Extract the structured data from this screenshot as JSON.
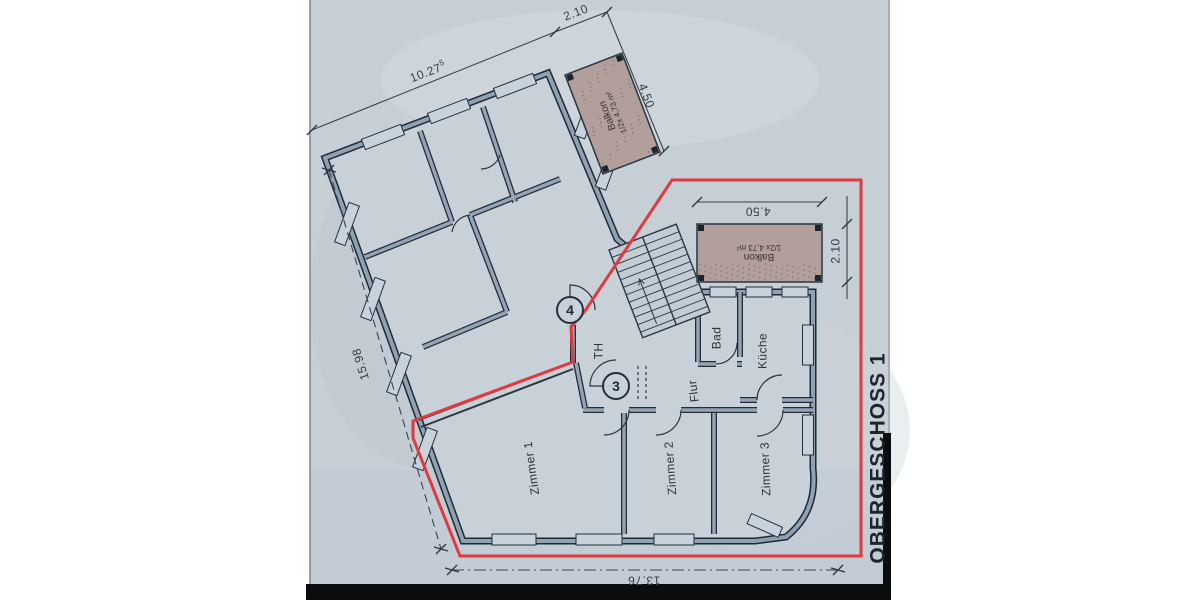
{
  "title": {
    "label": "OBERGESCHOSS 1"
  },
  "rooms": {
    "zimmer1": {
      "label": "Zimmer 1"
    },
    "zimmer2": {
      "label": "Zimmer 2"
    },
    "zimmer3": {
      "label": "Zimmer 3"
    },
    "flur": {
      "label": "Flur"
    },
    "bad": {
      "label": "Bad"
    },
    "kueche": {
      "label": "Küche"
    },
    "th": {
      "label": "TH"
    }
  },
  "balconies": {
    "b1": {
      "line1": "Balkon",
      "line2": "1/2x 4,73 m²"
    },
    "b2": {
      "line1": "Balkon",
      "line2": "1/2x 4,73 m²"
    }
  },
  "dimensions": {
    "top_balcony_width": "2.10",
    "top_length": "10.27",
    "top_length_sup": "5",
    "balcony1_length": "4.50",
    "balcony2_width": "4.50",
    "balcony2_depth": "2.10",
    "left_length": "15.98",
    "bottom_width": "13.76"
  },
  "markers": {
    "m3": {
      "label": "3"
    },
    "m4": {
      "label": "4"
    }
  },
  "colors": {
    "paper": "#c6ced6",
    "wall_dark": "#1f2a36",
    "wall_fill": "#8fa2b2",
    "balcony_fill": "#b29e9a",
    "unit_outline_red": "#e03a40",
    "ink": "#2a3541"
  }
}
